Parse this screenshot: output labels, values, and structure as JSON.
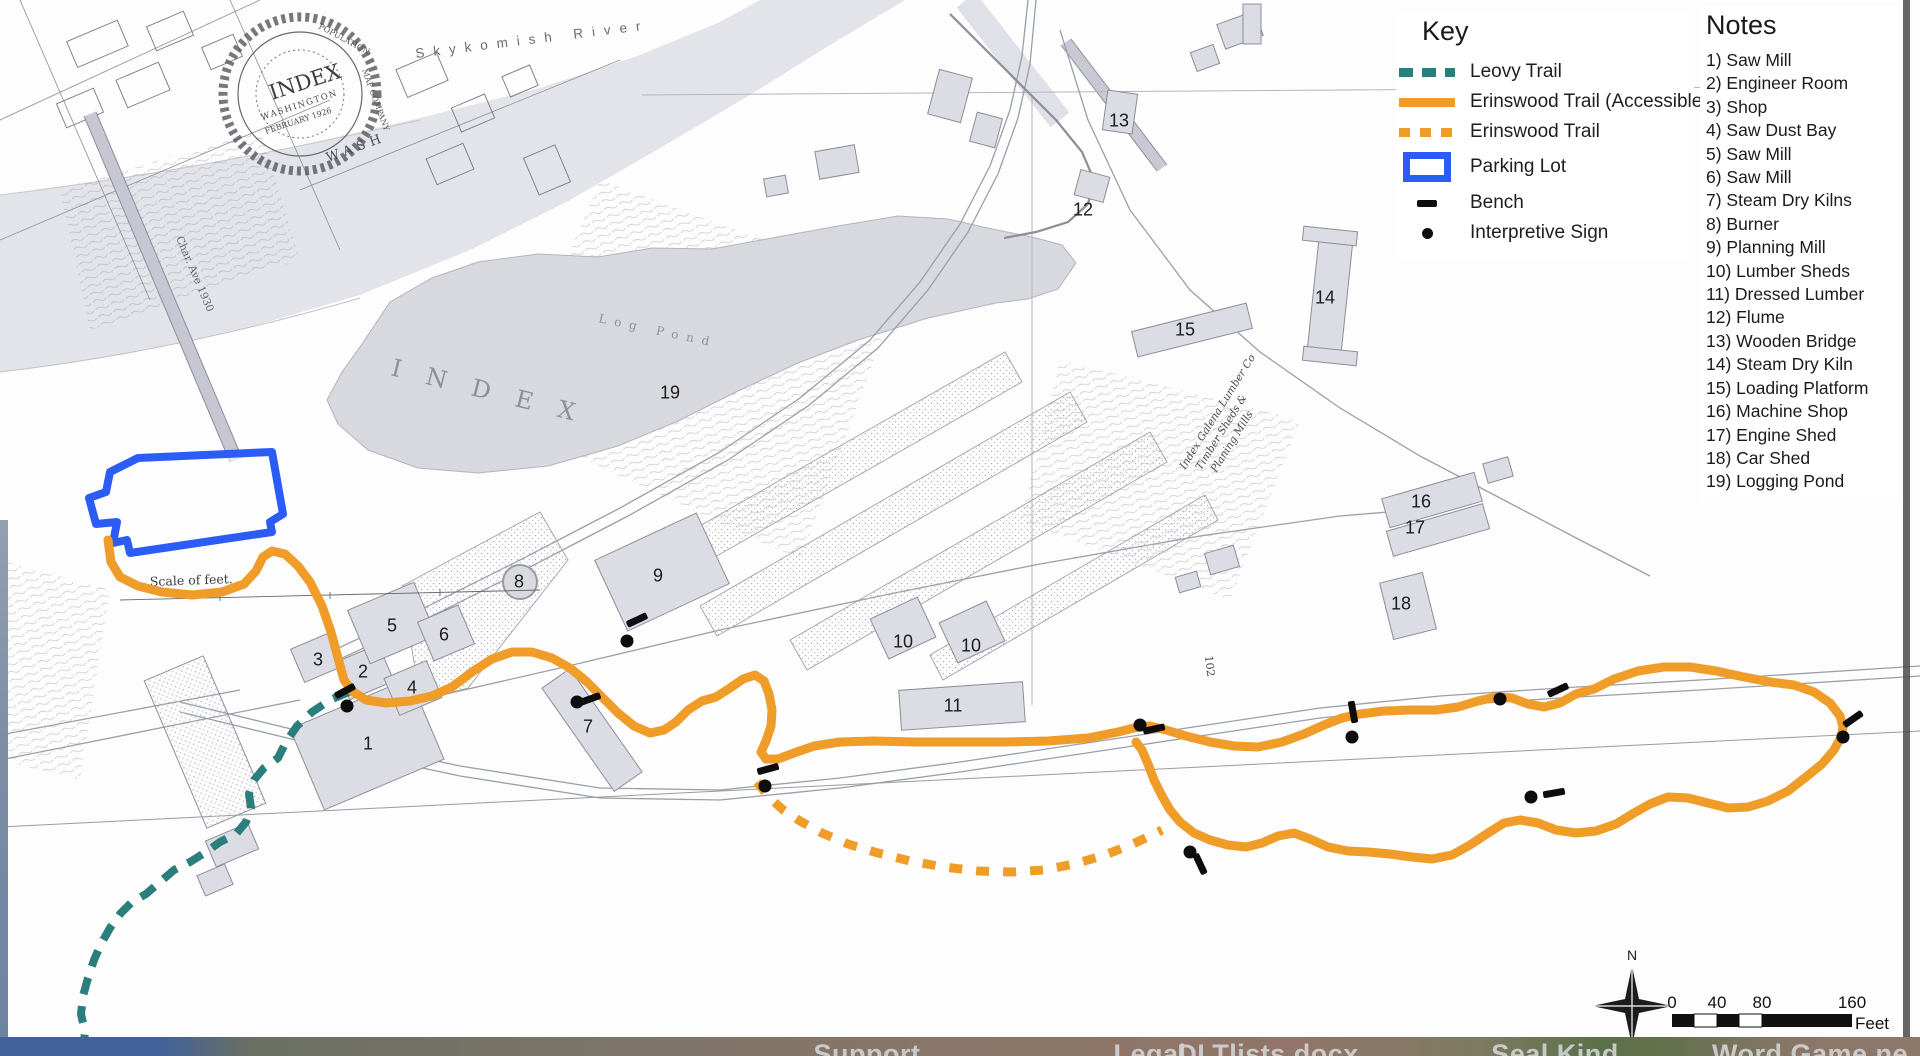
{
  "key": {
    "title": "Key",
    "items": [
      {
        "kind": "leovy-trail",
        "label": "Leovy Trail"
      },
      {
        "kind": "erinswood-accessible",
        "label": "Erinswood Trail (Accessible)"
      },
      {
        "kind": "erinswood",
        "label": "Erinswood Trail"
      },
      {
        "kind": "parking-lot",
        "label": "Parking Lot"
      },
      {
        "kind": "bench",
        "label": "Bench"
      },
      {
        "kind": "interpretive-sign",
        "label": "Interpretive Sign"
      }
    ]
  },
  "notes": {
    "title": "Notes",
    "items": [
      "1) Saw Mill",
      "2) Engineer Room",
      "3) Shop",
      "4) Saw Dust Bay",
      "5) Saw Mill",
      "6) Saw Mill",
      "7) Steam Dry Kilns",
      "8) Burner",
      "9) Planning Mill",
      "10) Lumber Sheds",
      "11) Dressed Lumber",
      "12) Flume",
      "13) Wooden Bridge",
      "14) Steam Dry Kiln",
      "15) Loading Platform",
      "16) Machine Shop",
      "17) Engine Shed",
      "18) Car Shed",
      "19) Logging Pond"
    ]
  },
  "colors": {
    "leovy_trail": "#2a7f7c",
    "erinswood_trail": "#f09c28",
    "parking_lot": "#2b5cf5",
    "marker": "#0d0d0d"
  },
  "map_labels": {
    "river": "Skykomish River",
    "pond_big": "INDEX",
    "pond": "Log Pond",
    "scale_note": "Scale of feet.",
    "road": "Char. Ave 1930",
    "wash": "WASH",
    "stamp_population": "POPULATION,",
    "stamp_company": "MAP COMPANY",
    "stamp_index": "INDEX",
    "stamp_state": "WASHINGTON",
    "stamp_date": "FEBRUARY 1926",
    "lumberco_1": "Index Galena Lumber Co",
    "lumberco_2": "Timber Sheds &",
    "lumberco_3": "Planing Mills",
    "n102": "102"
  },
  "scale_bar": {
    "north": "N",
    "ticks": [
      "0",
      "40",
      "80",
      "160"
    ],
    "unit": "Feet"
  },
  "building_numbers": [
    {
      "n": "1",
      "x": 368,
      "y": 744
    },
    {
      "n": "2",
      "x": 363,
      "y": 672
    },
    {
      "n": "3",
      "x": 318,
      "y": 660
    },
    {
      "n": "4",
      "x": 412,
      "y": 688
    },
    {
      "n": "5",
      "x": 392,
      "y": 626
    },
    {
      "n": "6",
      "x": 444,
      "y": 635
    },
    {
      "n": "7",
      "x": 588,
      "y": 727
    },
    {
      "n": "8",
      "x": 519,
      "y": 582
    },
    {
      "n": "9",
      "x": 658,
      "y": 576
    },
    {
      "n": "10",
      "x": 903,
      "y": 642
    },
    {
      "n": "10",
      "x": 971,
      "y": 646
    },
    {
      "n": "11",
      "x": 953,
      "y": 706
    },
    {
      "n": "12",
      "x": 1083,
      "y": 210
    },
    {
      "n": "13",
      "x": 1119,
      "y": 121
    },
    {
      "n": "14",
      "x": 1325,
      "y": 298
    },
    {
      "n": "15",
      "x": 1185,
      "y": 330
    },
    {
      "n": "16",
      "x": 1421,
      "y": 502
    },
    {
      "n": "17",
      "x": 1415,
      "y": 528
    },
    {
      "n": "18",
      "x": 1401,
      "y": 604
    },
    {
      "n": "19",
      "x": 670,
      "y": 393
    }
  ],
  "benches": [
    {
      "x": 345,
      "y": 691,
      "angle": -28
    },
    {
      "x": 590,
      "y": 699,
      "angle": -20
    },
    {
      "x": 637,
      "y": 620,
      "angle": -25
    },
    {
      "x": 768,
      "y": 769,
      "angle": -15
    },
    {
      "x": 1154,
      "y": 729,
      "angle": -12
    },
    {
      "x": 1353,
      "y": 712,
      "angle": 80
    },
    {
      "x": 1558,
      "y": 690,
      "angle": -25
    },
    {
      "x": 1554,
      "y": 793,
      "angle": -10
    },
    {
      "x": 1853,
      "y": 719,
      "angle": -35
    },
    {
      "x": 1200,
      "y": 864,
      "angle": 65
    }
  ],
  "signs": [
    {
      "x": 347,
      "y": 706
    },
    {
      "x": 577,
      "y": 702
    },
    {
      "x": 627,
      "y": 641
    },
    {
      "x": 765,
      "y": 786
    },
    {
      "x": 1140,
      "y": 725
    },
    {
      "x": 1352,
      "y": 737
    },
    {
      "x": 1500,
      "y": 699
    },
    {
      "x": 1531,
      "y": 797
    },
    {
      "x": 1190,
      "y": 852
    },
    {
      "x": 1843,
      "y": 737
    }
  ],
  "taskbar": {
    "items": [
      {
        "label": "Support",
        "x": 867
      },
      {
        "label": "Legal",
        "x": 1150
      },
      {
        "label": "DLTlists.docx",
        "x": 1268
      },
      {
        "label": "Seal Kind",
        "x": 1555
      },
      {
        "label": "Word Game ne",
        "x": 1810
      }
    ]
  }
}
